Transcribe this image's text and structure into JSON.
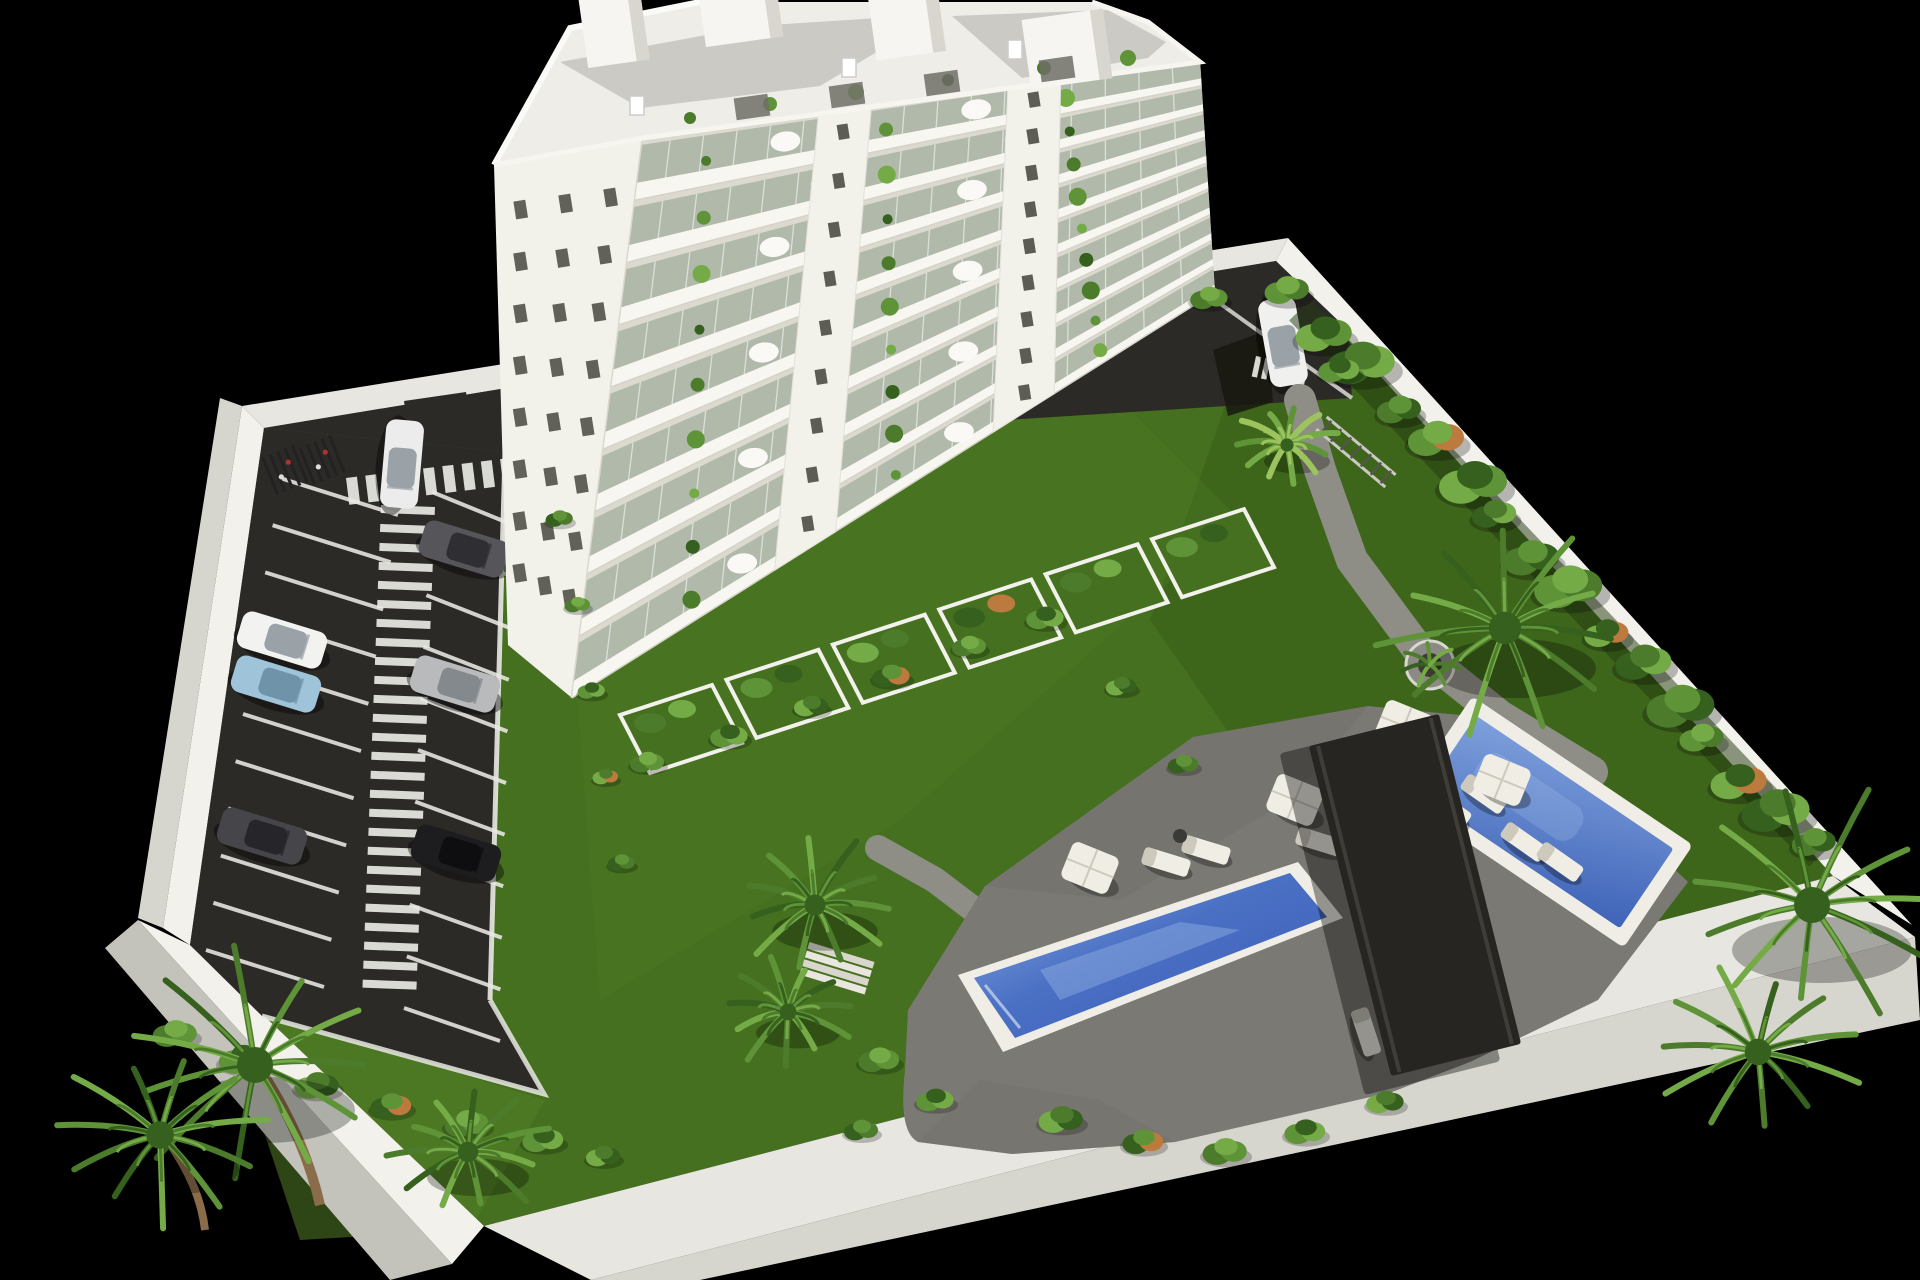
{
  "scene": {
    "title": "Aerial 3D architectural rendering of a white apartment tower inside a walled plot with parking lot, gardens, palm trees, pergola and two swimming pools on a black background",
    "palette": {
      "background": "#000000",
      "grass": "#45701f",
      "grassLight": "#538027",
      "grassDark": "#365c17",
      "asphalt": "#2c2a27",
      "asphaltLight": "#3a3834",
      "marking": "#e9e9e4",
      "wallBright": "#f2f1eb",
      "wallLight": "#e7e6e0",
      "wallMid": "#d6d5ce",
      "wallShadow": "#c3c2bb",
      "buildingWhite": "#f2f1ea",
      "buildingShade": "#dcd9cf",
      "glass": "#a9b3a5",
      "roofGravel": "#c9c8c3",
      "windowDark": "#4c4c46",
      "deck": "#7b7973",
      "deckDark": "#6e6c66",
      "path": "#8e8d86",
      "coping": "#efede5",
      "waterLight": "#7ea0dc",
      "waterMid": "#4a70c4",
      "waterDeep": "#3a5cb4",
      "pergola": "#262521",
      "pergolaSlat": "#45443e",
      "furniture": "#efede4",
      "furnitureShade": "#cdc9bd",
      "trunk": "#8a6b4a",
      "planter": "#8b8a84",
      "green1": "#4c7c2b",
      "green2": "#5f9338",
      "green3": "#74ab47",
      "green4": "#35601d",
      "greenPale": "#9cc35e",
      "orange": "#bd7a3e"
    },
    "building": {
      "balconyFloors": 9,
      "windowRows": 8,
      "windowCols": 3,
      "roofBulkheads": 4,
      "facadePiers": 2,
      "penthousePlants": 6,
      "penthouseWindows": 4,
      "terraceGardens": 6
    },
    "parking": {
      "markedSpacesLeft": 10,
      "markedSpacesRight": 10,
      "ladderStripes": 26,
      "entranceZebraStripes": 9,
      "drivewayZebraStripes": 6,
      "bikeRacks": 2
    },
    "vehicles": {
      "cars": [
        {
          "name": "white-car-at-entrance",
          "body": "#ececec",
          "cabin": "#9aa2a8"
        },
        {
          "name": "white-car-on-rear-driveway",
          "body": "#f0f0ef",
          "cabin": "#9aa2a8"
        },
        {
          "name": "white-parked-car",
          "body": "#f2f2f1",
          "cabin": "#9aa2a8"
        },
        {
          "name": "light-blue-parked-car",
          "body": "#9fc4da",
          "cabin": "#6f93a8"
        },
        {
          "name": "dark-gray-parked-car-left",
          "body": "#46464a",
          "cabin": "#26262a"
        },
        {
          "name": "dark-gray-parked-car-right",
          "body": "#55555a",
          "cabin": "#2e2e33"
        },
        {
          "name": "silver-parked-car",
          "body": "#b9babc",
          "cabin": "#84898e"
        },
        {
          "name": "black-parked-car",
          "body": "#1d1d1f",
          "cabin": "#0e0e10"
        }
      ]
    },
    "pools": {
      "count": 2,
      "labels": [
        "main-swimming-pool",
        "second-swimming-pool"
      ]
    },
    "amenities": {
      "pergolas": 1,
      "parasols": 4,
      "sunLoungers": 10,
      "sideTables": 1,
      "roundPlanters": 1,
      "stepFlights": 1
    },
    "vegetation": {
      "palmClusters": 9,
      "hedgeBushes": 16,
      "gardenShrubs": 30,
      "balconyPlantsPerFloor": 3
    }
  }
}
